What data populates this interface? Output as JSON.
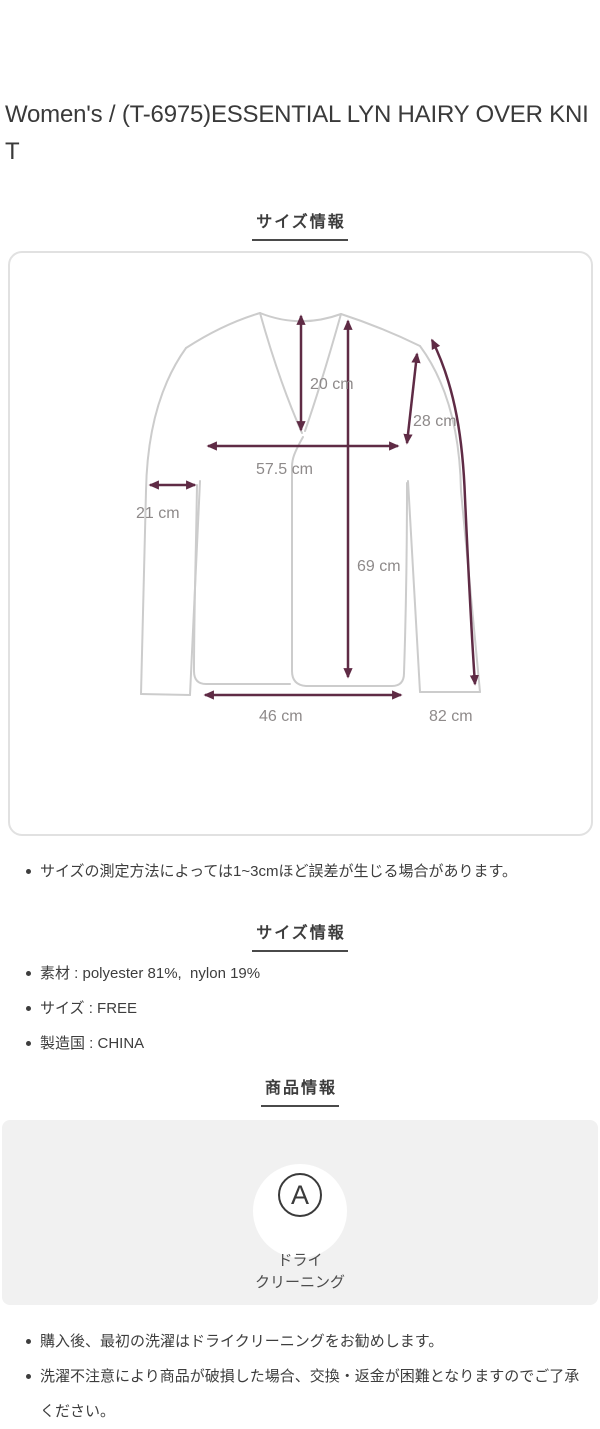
{
  "page": {
    "title": "Women's / (T-6975)ESSENTIAL LYN HAIRY OVER KNIT"
  },
  "size_section": {
    "heading": "サイズ情報",
    "measurements": [
      {
        "name": "neck-drop",
        "label": "20 cm"
      },
      {
        "name": "armhole",
        "label": "28 cm"
      },
      {
        "name": "chest-width",
        "label": "57.5 cm"
      },
      {
        "name": "sleeve-width",
        "label": "21 cm"
      },
      {
        "name": "total-length",
        "label": "69 cm"
      },
      {
        "name": "hem-width",
        "label": "46 cm"
      },
      {
        "name": "sleeve-length",
        "label": "82 cm"
      }
    ],
    "note": "サイズの測定方法によっては1~3cmほど誤差が生じる場合があります。"
  },
  "spec_section": {
    "heading": "サイズ情報",
    "items": [
      "素材 : polyester 81%,  nylon 19%",
      "サイズ : FREE",
      "製造国 : CHINA"
    ]
  },
  "product_section": {
    "heading": "商品情報",
    "care": {
      "icon_letter": "A",
      "label_line1": "ドライ",
      "label_line2": "クリーニング"
    },
    "notes": [
      "購入後、最初の洗濯はドライクリーニングをお勧めします。",
      "洗濯不注意により商品が破損した場合、交換・返金が困難となりますのでご了承ください。"
    ]
  },
  "colors": {
    "measure_line": "#5f2b45",
    "garment_line": "#cccccc",
    "measure_label": "#8e8a8a",
    "panel_background": "#f1f1f1",
    "text": "#3d3d3d"
  }
}
